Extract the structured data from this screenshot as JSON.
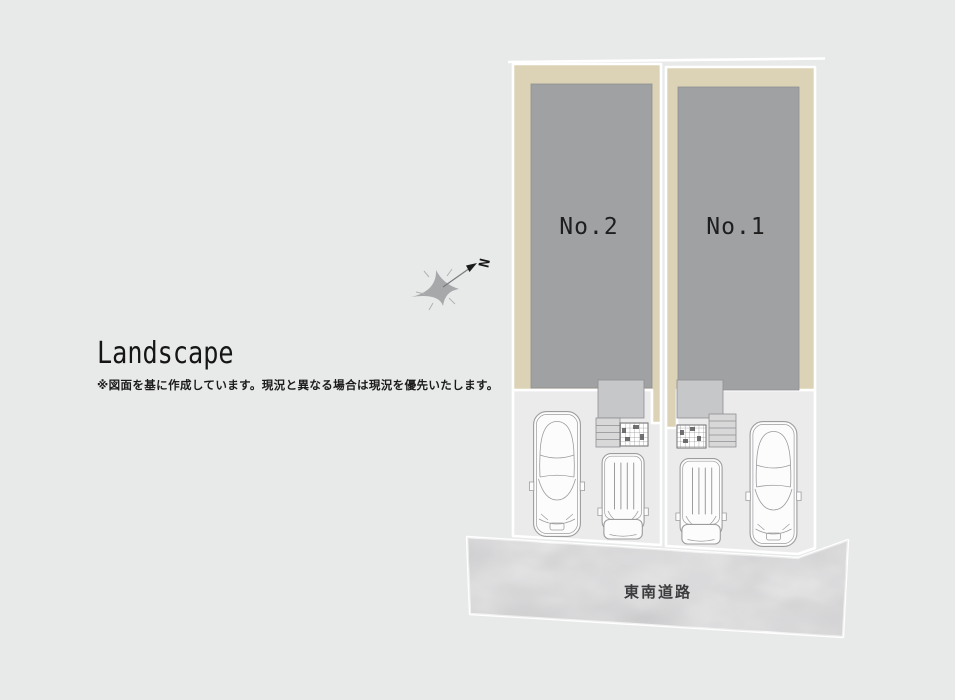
{
  "header": {
    "title": "Landscape",
    "disclaimer": "※図面を基に作成しています。現況と異なる場合は現況を優先いたします。"
  },
  "site_plan": {
    "lots": [
      {
        "id": "lot-2",
        "label": "No.2"
      },
      {
        "id": "lot-1",
        "label": "No.1"
      }
    ],
    "road": {
      "label": "東南道路"
    },
    "compass": {
      "label": "N",
      "direction": "northeast"
    }
  },
  "colors": {
    "background": "#e8e9e9",
    "lot_pad": "#dcd2b5",
    "building": "#a0a1a3",
    "porch": "#c6c7c8",
    "steps": "#d8d8d9",
    "parking": "#ebebec",
    "road": "#c6c6c8",
    "road_text": "#3c3c3e",
    "outline": "#ffffff",
    "car_outline": "#9c9c9e",
    "text": "#1e1e1e"
  }
}
